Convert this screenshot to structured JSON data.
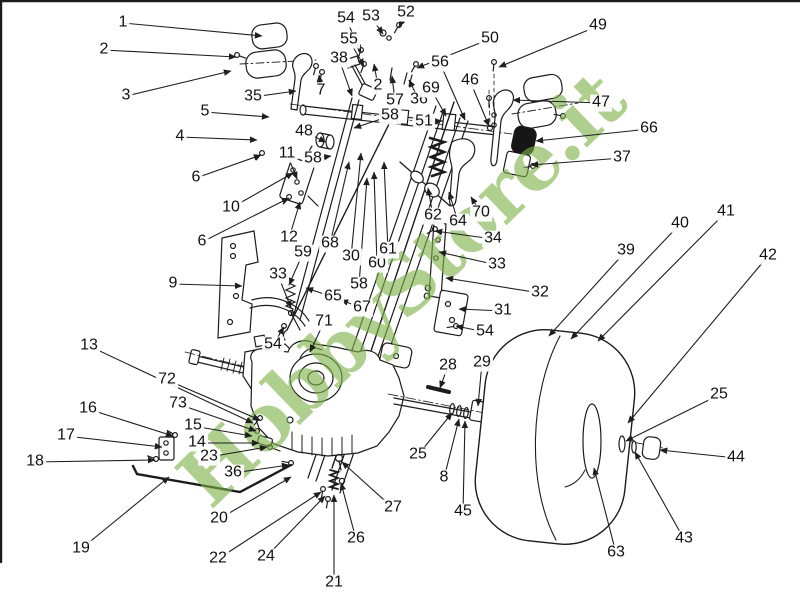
{
  "watermark": {
    "text": "HobbyStore.it",
    "color": "rgba(125,178,72,0.62)"
  },
  "diagram": {
    "line_color": "#1c1c1c",
    "background": "#ffffff",
    "label_color": "#111111"
  },
  "callouts": [
    {
      "n": "1",
      "lx": 123,
      "ly": 23,
      "tx": 262,
      "ty": 36
    },
    {
      "n": "2",
      "lx": 104,
      "ly": 50,
      "tx": 236,
      "ty": 57
    },
    {
      "n": "2",
      "lx": 378,
      "ly": 86,
      "tx": 374,
      "ty": 64
    },
    {
      "n": "3",
      "lx": 126,
      "ly": 96,
      "tx": 231,
      "ty": 71
    },
    {
      "n": "4",
      "lx": 180,
      "ly": 137,
      "tx": 257,
      "ty": 140
    },
    {
      "n": "5",
      "lx": 205,
      "ly": 112,
      "tx": 269,
      "ty": 117
    },
    {
      "n": "6",
      "lx": 196,
      "ly": 178,
      "tx": 261,
      "ty": 155
    },
    {
      "n": "6",
      "lx": 202,
      "ly": 242,
      "tx": 289,
      "ty": 198
    },
    {
      "n": "7",
      "lx": 321,
      "ly": 91,
      "tx": 319,
      "ty": 75
    },
    {
      "n": "8",
      "lx": 444,
      "ly": 478,
      "tx": 459,
      "ty": 419
    },
    {
      "n": "9",
      "lx": 173,
      "ly": 284,
      "tx": 242,
      "ty": 286
    },
    {
      "n": "10",
      "lx": 231,
      "ly": 208,
      "tx": 293,
      "ty": 173
    },
    {
      "n": "11",
      "lx": 287,
      "ly": 154,
      "tx": 297,
      "ty": 179
    },
    {
      "n": "12",
      "lx": 289,
      "ly": 238,
      "tx": 300,
      "ty": 202
    },
    {
      "n": "13",
      "lx": 89,
      "ly": 346,
      "tx": 253,
      "ty": 423
    },
    {
      "n": "14",
      "lx": 197,
      "ly": 443,
      "tx": 259,
      "ty": 443
    },
    {
      "n": "15",
      "lx": 193,
      "ly": 426,
      "tx": 252,
      "ty": 436
    },
    {
      "n": "16",
      "lx": 88,
      "ly": 409,
      "tx": 173,
      "ty": 436
    },
    {
      "n": "17",
      "lx": 66,
      "ly": 436,
      "tx": 162,
      "ty": 447
    },
    {
      "n": "18",
      "lx": 35,
      "ly": 462,
      "tx": 155,
      "ty": 460
    },
    {
      "n": "19",
      "lx": 81,
      "ly": 549,
      "tx": 169,
      "ty": 477
    },
    {
      "n": "20",
      "lx": 219,
      "ly": 519,
      "tx": 291,
      "ty": 477
    },
    {
      "n": "21",
      "lx": 334,
      "ly": 583,
      "tx": 334,
      "ty": 495
    },
    {
      "n": "22",
      "lx": 218,
      "ly": 559,
      "tx": 321,
      "ty": 492
    },
    {
      "n": "23",
      "lx": 209,
      "ly": 457,
      "tx": 267,
      "ty": 447
    },
    {
      "n": "24",
      "lx": 266,
      "ly": 557,
      "tx": 325,
      "ty": 496
    },
    {
      "n": "25",
      "lx": 418,
      "ly": 455,
      "tx": 452,
      "ty": 413
    },
    {
      "n": "25",
      "lx": 719,
      "ly": 395,
      "tx": 626,
      "ty": 441
    },
    {
      "n": "26",
      "lx": 356,
      "ly": 539,
      "tx": 341,
      "ty": 483
    },
    {
      "n": "27",
      "lx": 393,
      "ly": 508,
      "tx": 342,
      "ty": 462
    },
    {
      "n": "28",
      "lx": 448,
      "ly": 366,
      "tx": 440,
      "ty": 388
    },
    {
      "n": "29",
      "lx": 482,
      "ly": 363,
      "tx": 478,
      "ty": 406
    },
    {
      "n": "30",
      "lx": 351,
      "ly": 257,
      "tx": 361,
      "ty": 153
    },
    {
      "n": "31",
      "lx": 503,
      "ly": 311,
      "tx": 459,
      "ty": 309
    },
    {
      "n": "32",
      "lx": 540,
      "ly": 293,
      "tx": 446,
      "ty": 278
    },
    {
      "n": "33",
      "lx": 278,
      "ly": 275,
      "tx": 291,
      "ty": 308
    },
    {
      "n": "33",
      "lx": 497,
      "ly": 265,
      "tx": 439,
      "ty": 252
    },
    {
      "n": "34",
      "lx": 493,
      "ly": 239,
      "tx": 435,
      "ty": 231
    },
    {
      "n": "35",
      "lx": 253,
      "ly": 97,
      "tx": 296,
      "ty": 91
    },
    {
      "n": "36",
      "lx": 419,
      "ly": 100,
      "tx": 409,
      "ty": 80
    },
    {
      "n": "36",
      "lx": 233,
      "ly": 473,
      "tx": 289,
      "ty": 465
    },
    {
      "n": "37",
      "lx": 622,
      "ly": 158,
      "tx": 531,
      "ty": 165
    },
    {
      "n": "38",
      "lx": 339,
      "ly": 59,
      "tx": 352,
      "ty": 96
    },
    {
      "n": "39",
      "lx": 626,
      "ly": 251,
      "tx": 549,
      "ty": 336
    },
    {
      "n": "40",
      "lx": 680,
      "ly": 224,
      "tx": 571,
      "ty": 339
    },
    {
      "n": "41",
      "lx": 726,
      "ly": 212,
      "tx": 598,
      "ty": 341
    },
    {
      "n": "42",
      "lx": 768,
      "ly": 256,
      "tx": 628,
      "ty": 423
    },
    {
      "n": "43",
      "lx": 684,
      "ly": 539,
      "tx": 635,
      "ty": 452
    },
    {
      "n": "44",
      "lx": 736,
      "ly": 458,
      "tx": 660,
      "ty": 450
    },
    {
      "n": "45",
      "lx": 463,
      "ly": 512,
      "tx": 465,
      "ty": 421
    },
    {
      "n": "46",
      "lx": 470,
      "ly": 81,
      "tx": 489,
      "ty": 126
    },
    {
      "n": "47",
      "lx": 601,
      "ly": 103,
      "tx": 513,
      "ty": 100
    },
    {
      "n": "48",
      "lx": 304,
      "ly": 132,
      "tx": 326,
      "ty": 142
    },
    {
      "n": "49",
      "lx": 598,
      "ly": 26,
      "tx": 499,
      "ty": 67
    },
    {
      "n": "50",
      "lx": 490,
      "ly": 39,
      "tx": 417,
      "ty": 68
    },
    {
      "n": "51",
      "lx": 424,
      "ly": 122,
      "tx": 442,
      "ty": 121
    },
    {
      "n": "52",
      "lx": 406,
      "ly": 13,
      "tx": 399,
      "ty": 27
    },
    {
      "n": "53",
      "lx": 371,
      "ly": 17,
      "tx": 383,
      "ty": 34
    },
    {
      "n": "54",
      "lx": 346,
      "ly": 19,
      "tx": 361,
      "ty": 52
    },
    {
      "n": "54",
      "lx": 485,
      "ly": 332,
      "tx": 456,
      "ty": 326
    },
    {
      "n": "54",
      "lx": 273,
      "ly": 345,
      "tx": 284,
      "ty": 327
    },
    {
      "n": "55",
      "lx": 349,
      "ly": 40,
      "tx": 364,
      "ty": 66
    },
    {
      "n": "56",
      "lx": 440,
      "ly": 63,
      "tx": 465,
      "ty": 120
    },
    {
      "n": "57",
      "lx": 395,
      "ly": 101,
      "tx": 392,
      "ty": 76
    },
    {
      "n": "58",
      "lx": 313,
      "ly": 159,
      "tx": 331,
      "ty": 156
    },
    {
      "n": "58",
      "lx": 390,
      "ly": 116,
      "tx": 354,
      "ty": 128
    },
    {
      "n": "58",
      "lx": 359,
      "ly": 285,
      "tx": 367,
      "ty": 178
    },
    {
      "n": "59",
      "lx": 303,
      "ly": 253,
      "tx": 289,
      "ty": 285
    },
    {
      "n": "60",
      "lx": 377,
      "ly": 264,
      "tx": 374,
      "ty": 172
    },
    {
      "n": "61",
      "lx": 388,
      "ly": 250,
      "tx": 384,
      "ty": 162
    },
    {
      "n": "62",
      "lx": 433,
      "ly": 216,
      "tx": 428,
      "ty": 188
    },
    {
      "n": "63",
      "lx": 616,
      "ly": 553,
      "tx": 594,
      "ty": 468
    },
    {
      "n": "64",
      "lx": 458,
      "ly": 222,
      "tx": 449,
      "ty": 192
    },
    {
      "n": "65",
      "lx": 333,
      "ly": 297,
      "tx": 306,
      "ty": 288
    },
    {
      "n": "66",
      "lx": 649,
      "ly": 129,
      "tx": 536,
      "ty": 141
    },
    {
      "n": "67",
      "lx": 362,
      "ly": 308,
      "tx": 341,
      "ty": 300
    },
    {
      "n": "68",
      "lx": 330,
      "ly": 244,
      "tx": 349,
      "ty": 162
    },
    {
      "n": "69",
      "lx": 431,
      "ly": 89,
      "tx": 446,
      "ty": 116
    },
    {
      "n": "70",
      "lx": 481,
      "ly": 213,
      "tx": 471,
      "ty": 197
    },
    {
      "n": "71",
      "lx": 324,
      "ly": 322,
      "tx": 310,
      "ty": 352
    },
    {
      "n": "72",
      "lx": 167,
      "ly": 380,
      "tx": 260,
      "ty": 420
    },
    {
      "n": "73",
      "lx": 178,
      "ly": 404,
      "tx": 256,
      "ty": 431
    }
  ]
}
